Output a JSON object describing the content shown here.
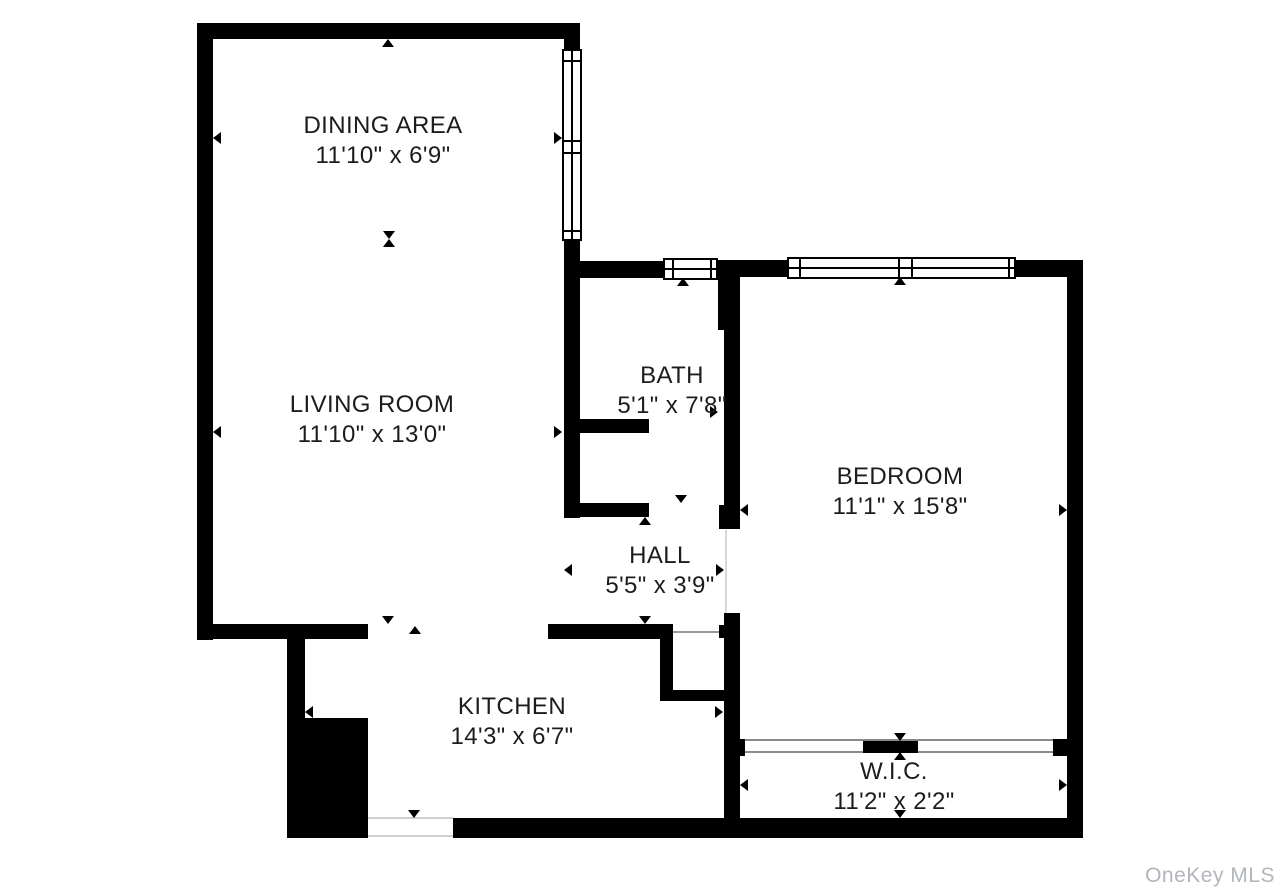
{
  "watermark": "OneKey MLS",
  "plan": {
    "colors": {
      "wall": "#000000",
      "text": "#1c1c1c",
      "watermark": "#b2b6bc"
    },
    "rooms": [
      {
        "name": "DINING AREA",
        "dims": "11'10\" x 6'9\"",
        "cx": 383,
        "cy": 141
      },
      {
        "name": "LIVING ROOM",
        "dims": "11'10\" x 13'0\"",
        "cx": 372,
        "cy": 420
      },
      {
        "name": "BATH",
        "dims": "5'1\" x 7'8\"",
        "cx": 672,
        "cy": 391
      },
      {
        "name": "HALL",
        "dims": "5'5\" x 3'9\"",
        "cx": 660,
        "cy": 571
      },
      {
        "name": "BEDROOM",
        "dims": "11'1\" x 15'8\"",
        "cx": 900,
        "cy": 492
      },
      {
        "name": "KITCHEN",
        "dims": "14'3\" x 6'7\"",
        "cx": 512,
        "cy": 722
      },
      {
        "name": "W.I.C.",
        "dims": "11'2\" x 2'2\"",
        "cx": 894,
        "cy": 787
      }
    ],
    "walls": [
      {
        "x": 197,
        "y": 23,
        "w": 383,
        "h": 16
      },
      {
        "x": 197,
        "y": 23,
        "w": 16,
        "h": 617
      },
      {
        "x": 564,
        "y": 39,
        "w": 16,
        "h": 11
      },
      {
        "x": 564,
        "y": 239,
        "w": 16,
        "h": 279
      },
      {
        "x": 564,
        "y": 419,
        "w": 85,
        "h": 14
      },
      {
        "x": 564,
        "y": 503,
        "w": 85,
        "h": 14
      },
      {
        "x": 197,
        "y": 624,
        "w": 171,
        "h": 15
      },
      {
        "x": 287,
        "y": 624,
        "w": 18,
        "h": 95
      },
      {
        "x": 287,
        "y": 718,
        "w": 81,
        "h": 120
      },
      {
        "x": 453,
        "y": 818,
        "w": 630,
        "h": 20
      },
      {
        "x": 1067,
        "y": 260,
        "w": 16,
        "h": 578
      },
      {
        "x": 724,
        "y": 260,
        "w": 359,
        "h": 17
      },
      {
        "x": 564,
        "y": 261,
        "w": 160,
        "h": 17
      },
      {
        "x": 718,
        "y": 260,
        "w": 22,
        "h": 70
      },
      {
        "x": 724,
        "y": 330,
        "w": 16,
        "h": 175
      },
      {
        "x": 719,
        "y": 505,
        "w": 21,
        "h": 24
      },
      {
        "x": 724,
        "y": 613,
        "w": 16,
        "h": 225
      },
      {
        "x": 548,
        "y": 624,
        "w": 125,
        "h": 15
      },
      {
        "x": 719,
        "y": 625,
        "w": 6,
        "h": 13
      },
      {
        "x": 660,
        "y": 638,
        "w": 13,
        "h": 52
      },
      {
        "x": 660,
        "y": 690,
        "w": 70,
        "h": 11
      },
      {
        "x": 730,
        "y": 739,
        "w": 15,
        "h": 17
      },
      {
        "x": 863,
        "y": 741,
        "w": 55,
        "h": 12
      },
      {
        "x": 1053,
        "y": 739,
        "w": 15,
        "h": 17
      }
    ],
    "windows": [
      {
        "x": 562,
        "y": 49,
        "w": 20,
        "h": 192,
        "mid": "v",
        "lines": [
          {
            "axis": "h",
            "at": 9
          },
          {
            "axis": "h",
            "at": 89
          },
          {
            "axis": "h",
            "at": 101
          },
          {
            "axis": "h",
            "at": 179
          }
        ]
      },
      {
        "x": 663,
        "y": 258,
        "w": 55,
        "h": 22,
        "mid": "h",
        "lines": [
          {
            "axis": "v",
            "at": 7
          },
          {
            "axis": "v",
            "at": 45
          }
        ]
      },
      {
        "x": 787,
        "y": 257,
        "w": 229,
        "h": 22,
        "mid": "h",
        "lines": [
          {
            "axis": "v",
            "at": 10
          },
          {
            "axis": "v",
            "at": 109
          },
          {
            "axis": "v",
            "at": 122
          },
          {
            "axis": "v",
            "at": 219
          }
        ]
      }
    ],
    "door_lines": [
      {
        "x": 673,
        "y": 631,
        "w": 47,
        "h": 2,
        "c": "#9a9a9a"
      },
      {
        "x": 745,
        "y": 739,
        "w": 308,
        "h": 2,
        "c": "#8a8a8a"
      },
      {
        "x": 745,
        "y": 751,
        "w": 308,
        "h": 2,
        "c": "#8a8a8a"
      },
      {
        "x": 725,
        "y": 530,
        "w": 2,
        "h": 83,
        "c": "#d8d8d8"
      },
      {
        "x": 368,
        "y": 817,
        "w": 85,
        "h": 2,
        "c": "#d0d0d0"
      },
      {
        "x": 368,
        "y": 835,
        "w": 85,
        "h": 2,
        "c": "#d0d0d0"
      }
    ],
    "arrows": [
      {
        "x": 388,
        "y": 39,
        "d": "up"
      },
      {
        "x": 213,
        "y": 138,
        "d": "left"
      },
      {
        "x": 562,
        "y": 138,
        "d": "right"
      },
      {
        "x": 389,
        "y": 239,
        "d": "down"
      },
      {
        "x": 389,
        "y": 239,
        "d": "up"
      },
      {
        "x": 213,
        "y": 432,
        "d": "left"
      },
      {
        "x": 562,
        "y": 432,
        "d": "right"
      },
      {
        "x": 388,
        "y": 624,
        "d": "down"
      },
      {
        "x": 415,
        "y": 626,
        "d": "up"
      },
      {
        "x": 414,
        "y": 818,
        "d": "down"
      },
      {
        "x": 305,
        "y": 712,
        "d": "left"
      },
      {
        "x": 723,
        "y": 712,
        "d": "right"
      },
      {
        "x": 683,
        "y": 278,
        "d": "up"
      },
      {
        "x": 681,
        "y": 503,
        "d": "down"
      },
      {
        "x": 570,
        "y": 412,
        "d": "left"
      },
      {
        "x": 718,
        "y": 412,
        "d": "right"
      },
      {
        "x": 645,
        "y": 517,
        "d": "up"
      },
      {
        "x": 645,
        "y": 624,
        "d": "down"
      },
      {
        "x": 564,
        "y": 570,
        "d": "left"
      },
      {
        "x": 724,
        "y": 570,
        "d": "right"
      },
      {
        "x": 900,
        "y": 277,
        "d": "up"
      },
      {
        "x": 900,
        "y": 741,
        "d": "down"
      },
      {
        "x": 740,
        "y": 510,
        "d": "left"
      },
      {
        "x": 1067,
        "y": 510,
        "d": "right"
      },
      {
        "x": 900,
        "y": 752,
        "d": "up"
      },
      {
        "x": 900,
        "y": 818,
        "d": "down"
      },
      {
        "x": 740,
        "y": 785,
        "d": "left"
      },
      {
        "x": 1067,
        "y": 785,
        "d": "right"
      }
    ]
  }
}
